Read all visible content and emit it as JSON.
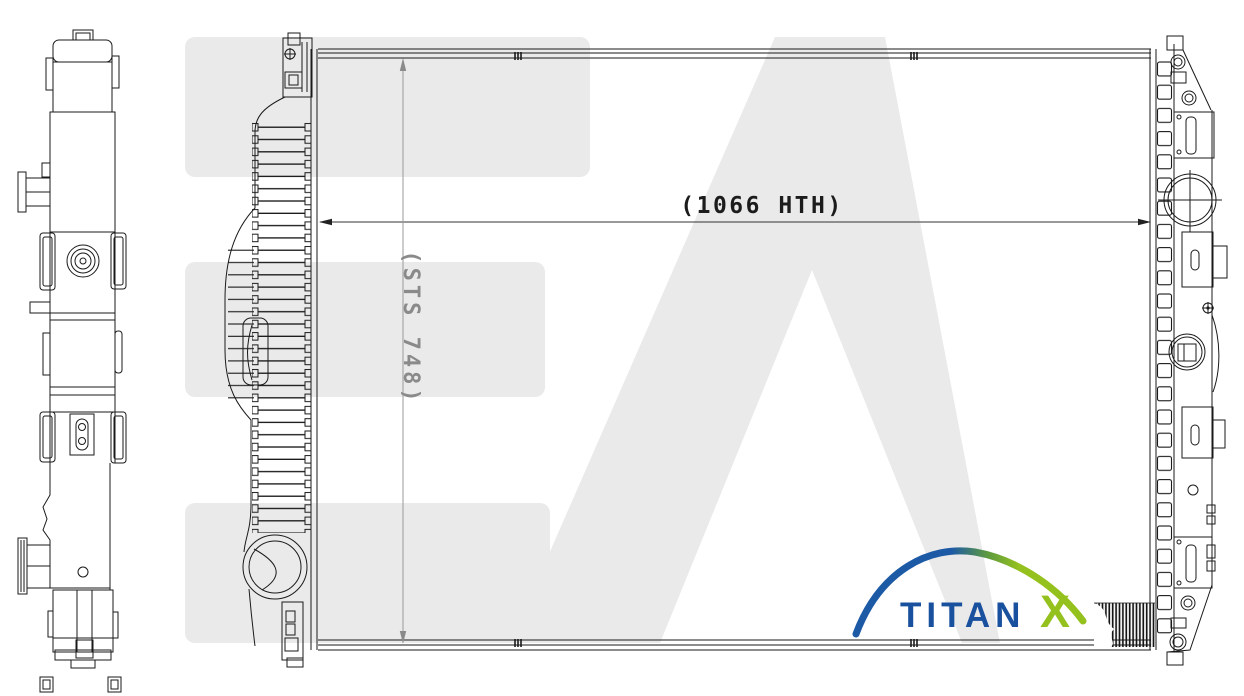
{
  "watermark": {
    "text": "EA",
    "color": "#eaeaea"
  },
  "dimensions": {
    "width_label": "(1066 HTH)",
    "height_label": "(STS 748)",
    "width_label_color": "#1c1c1c",
    "height_label_color": "#8a8a8a"
  },
  "logo": {
    "brand": "TITANX",
    "text_main": "TITAN",
    "text_x": "X",
    "color_blue": "#1a519f",
    "color_green": "#95c11f"
  },
  "drawing": {
    "line_color": "#1a1a1a",
    "views": [
      "side-view",
      "front-view"
    ]
  }
}
